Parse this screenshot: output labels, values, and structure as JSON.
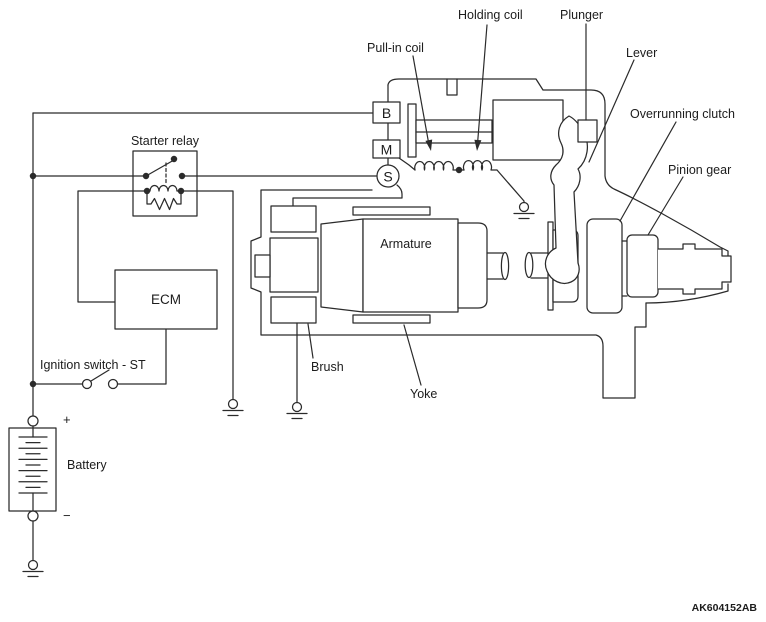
{
  "figure": {
    "code": "AK604152AB",
    "background": "#ffffff",
    "line_color": "#2b2b2b"
  },
  "labels": {
    "pull_in_coil": "Pull-in coil",
    "holding_coil": "Holding coil",
    "plunger": "Plunger",
    "lever": "Lever",
    "overrunning_clutch": "Overrunning clutch",
    "pinion_gear": "Pinion gear",
    "starter_relay": "Starter relay",
    "armature": "Armature",
    "brush": "Brush",
    "yoke": "Yoke",
    "ignition_switch_st": "Ignition switch - ST",
    "battery": "Battery",
    "ecm": "ECM"
  },
  "terminals": {
    "b": "B",
    "m": "M",
    "s": "S"
  },
  "battery_polarity": {
    "positive": "+",
    "negative": "−"
  }
}
